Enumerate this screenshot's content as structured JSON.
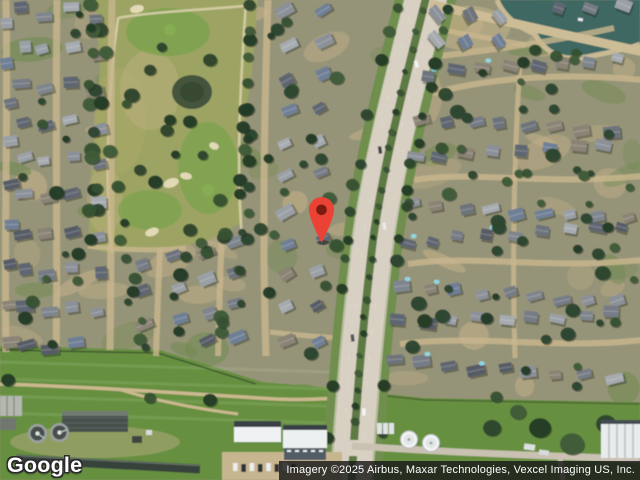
{
  "map": {
    "provider_logo": "Google",
    "attribution": "Imagery ©2025 Airbus, Maxar Technologies, Vexcel Imaging US, Inc.",
    "view": {
      "type": "satellite",
      "width": 640,
      "height": 480
    },
    "marker": {
      "icon": "map-pin-icon",
      "x": 321,
      "y": 243,
      "color": "#EA4335",
      "inner_color": "#7A1B0F"
    },
    "colors": {
      "base": "#969478",
      "ground_tan": "#c6b28a",
      "patch_green": "#6f8a50",
      "golf_olive": "#9da463",
      "golf_green": "#7da24d",
      "golf_sand": "#e6dcba",
      "pond": "#44543e",
      "lake": "#416863",
      "shore_path": "#cdbd96",
      "grass": "#669040",
      "road": "#d8d0c2",
      "verge": "#6f8e4e",
      "median": "#5d7a44",
      "street": "#c9b78f",
      "channel": "#39423c",
      "building_white": "#eff1f2",
      "apron_tan": "#c7b58f",
      "tree_dark": "#2d462e",
      "attribution_bg": "rgba(25,25,25,0.82)",
      "attribution_fg": "#ffffff",
      "logo_fill": "#ffffff",
      "logo_outline": "#2b2b2b"
    }
  }
}
